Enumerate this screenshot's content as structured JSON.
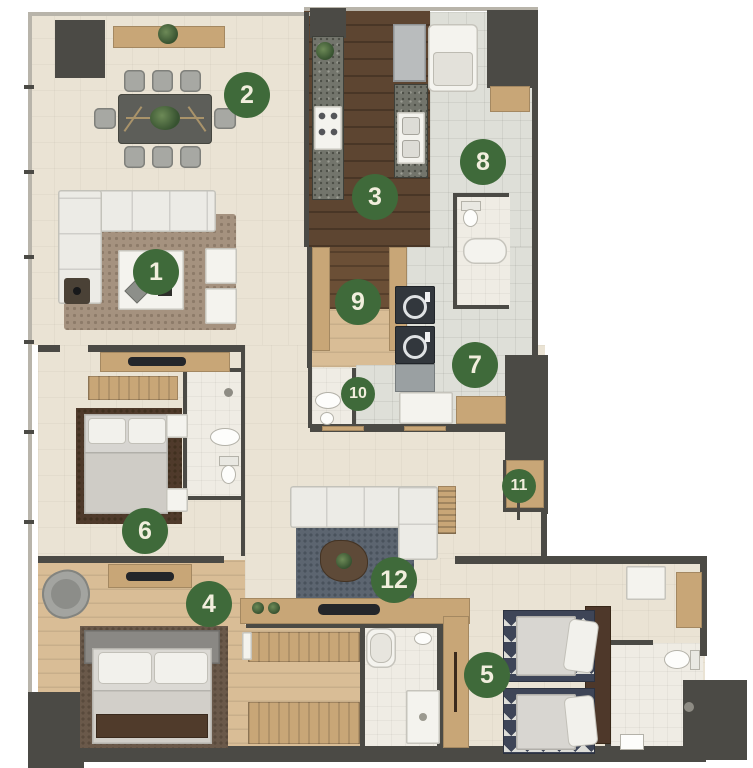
{
  "plan": {
    "markers": [
      {
        "label": "1",
        "x": 156,
        "y": 272,
        "size": "large"
      },
      {
        "label": "2",
        "x": 247,
        "y": 95,
        "size": "large"
      },
      {
        "label": "3",
        "x": 375,
        "y": 197,
        "size": "large"
      },
      {
        "label": "4",
        "x": 209,
        "y": 604,
        "size": "large"
      },
      {
        "label": "5",
        "x": 487,
        "y": 675,
        "size": "large"
      },
      {
        "label": "6",
        "x": 145,
        "y": 531,
        "size": "large"
      },
      {
        "label": "7",
        "x": 475,
        "y": 365,
        "size": "large"
      },
      {
        "label": "8",
        "x": 483,
        "y": 162,
        "size": "large"
      },
      {
        "label": "9",
        "x": 358,
        "y": 302,
        "size": "large"
      },
      {
        "label": "10",
        "x": 358,
        "y": 394,
        "size": "small"
      },
      {
        "label": "11",
        "x": 519,
        "y": 486,
        "size": "small"
      },
      {
        "label": "12",
        "x": 394,
        "y": 580,
        "size": "large"
      }
    ],
    "palette": {
      "marker_green": "#3f6a3a",
      "marker_text": "#f1eedd",
      "wall_dark": "#4b4a45",
      "floor_beige": "#eae3d4",
      "floor_wood_light": "#d9bd96",
      "floor_wood_dark": "#5d4531",
      "floor_tile": "#dedfd8",
      "furniture_wood": "#c8a677",
      "granite": "#73756c"
    }
  }
}
